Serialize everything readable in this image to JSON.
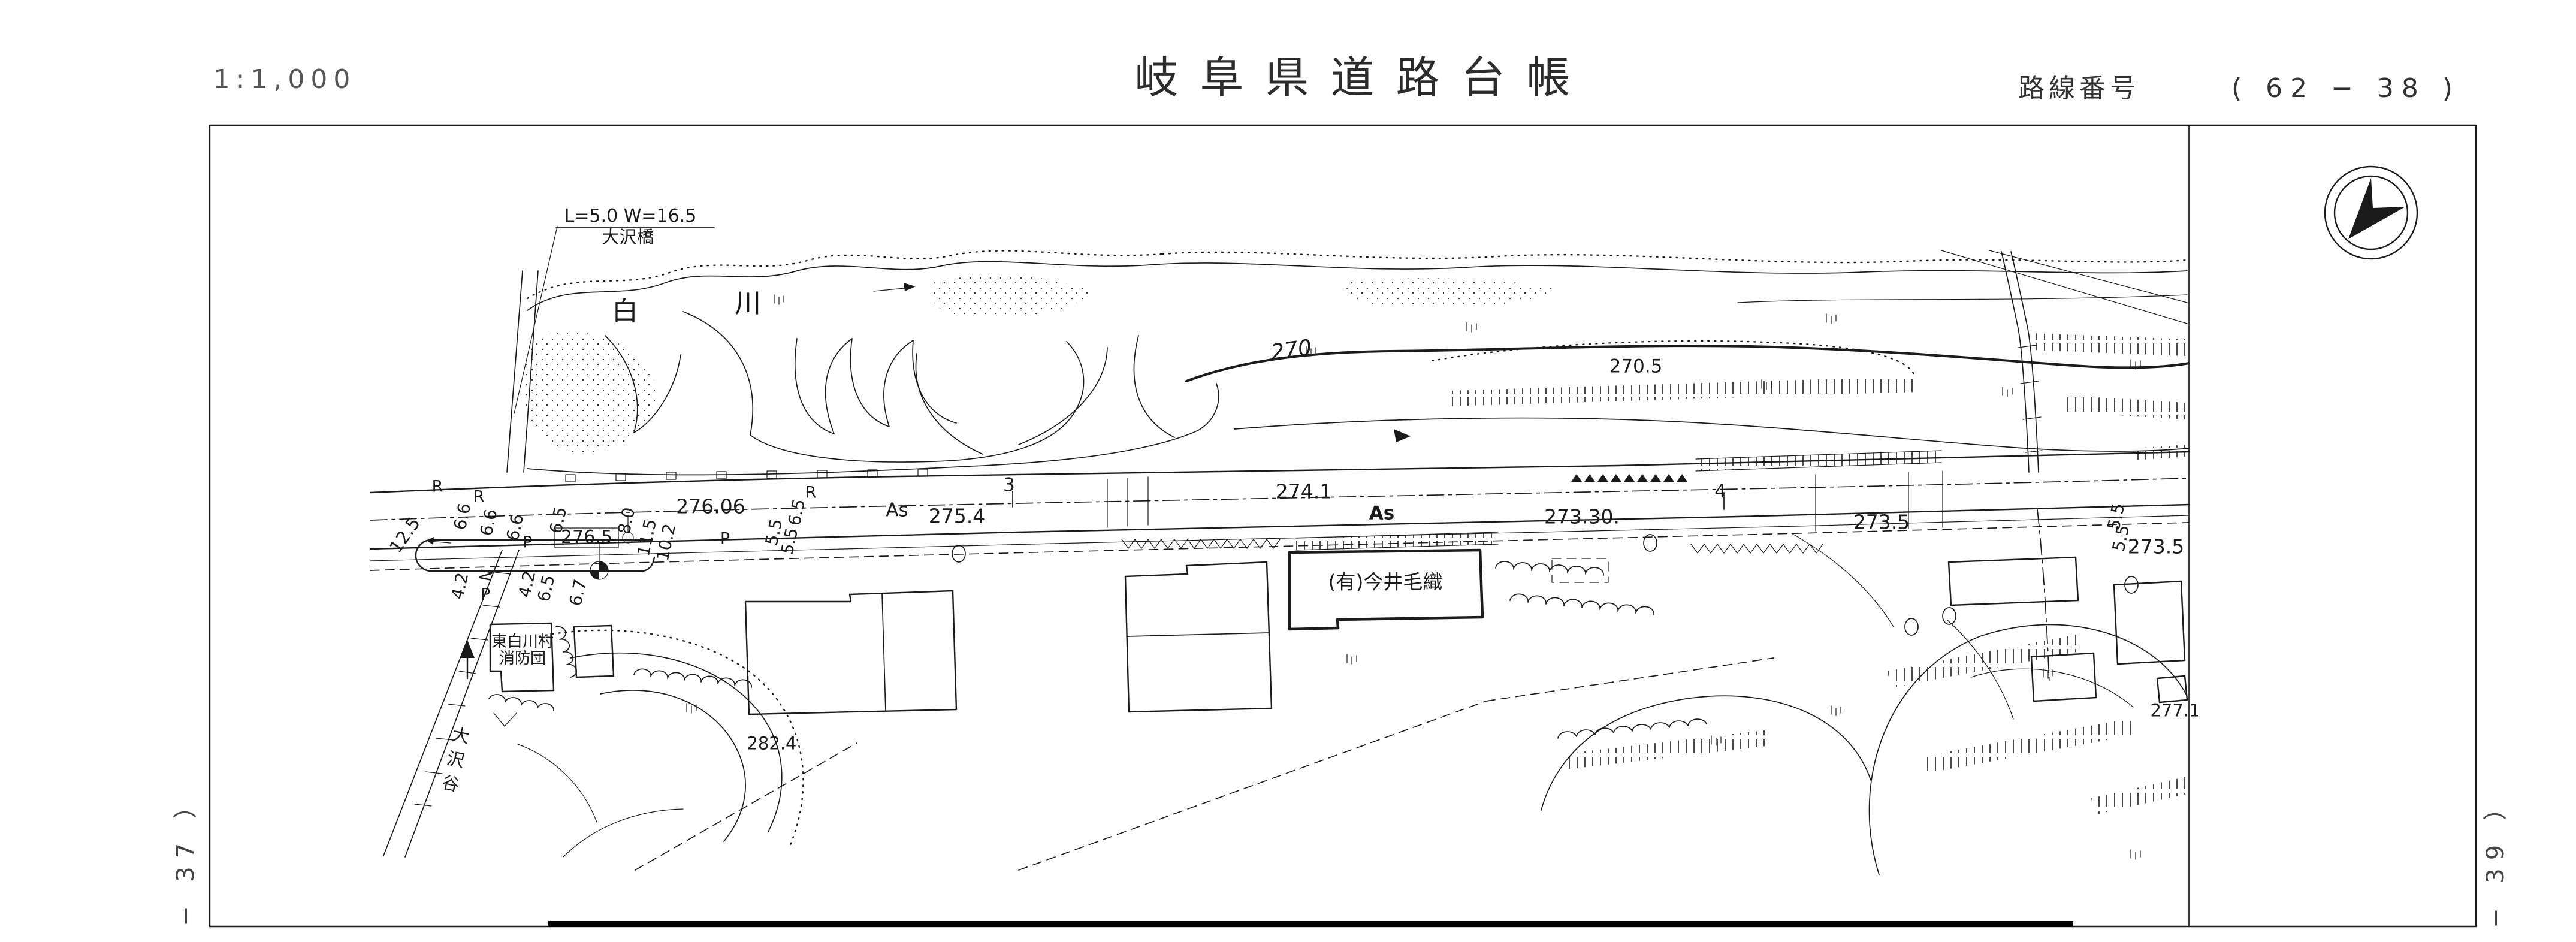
{
  "header": {
    "scale": "1:1,000",
    "title": "岐阜県道路台帳",
    "route_label": "路線番号",
    "route_number": "( 62 − 38 )"
  },
  "margins": {
    "left_sheet": "− 37 ）",
    "right_sheet": "− 39 ）"
  },
  "map": {
    "bridge_dims": "L=5.0 W=16.5",
    "bridge_name": "大沢橋",
    "river_char_1": "白",
    "river_char_2": "川",
    "contour_270": "270",
    "spot_270_5": "270.5",
    "spot_282_4": "282.4",
    "spot_277_1": "277.1",
    "valley_name": "大沢谷",
    "fire_brigade_1": "東白川村",
    "fire_brigade_2": "消防団",
    "company": "(有)今井毛織",
    "road": {
      "as_1": "As",
      "as_2": "As",
      "sta_3": "3",
      "sta_4": "4",
      "lv_276_06": "276.06",
      "lv_276_5": "276.5",
      "lv_275_4": "275.4",
      "lv_274_1": "274.1",
      "lv_273_30": "273.30.",
      "lv_273_5_a": "273.5",
      "lv_273_5_b": "273.5"
    },
    "widths": {
      "w_12_5": "12.5",
      "w_6_6_a": "6.6",
      "w_6_6_b": "6.6",
      "w_6_6_c": "6.6",
      "w_6_5_a": "6.5",
      "w_8_0": "8.0",
      "w_11_5": "11.5",
      "w_10_2": "10.2",
      "w_6_5_b": "6.5",
      "w_5_5_a": "5.5",
      "w_5_5_b": "5.5",
      "w_4_2_a": "4.2",
      "w_4_2_b": "4.2",
      "w_6_5_c": "6.5",
      "w_6_7": "6.7",
      "w_5_5_c": "5.5",
      "w_5_5_d": "5.5"
    },
    "marks": {
      "r_a": "R",
      "r_b": "R",
      "r_c": "R",
      "p_a": "P",
      "p_b": "P",
      "p_c": "P",
      "n": "N"
    }
  }
}
